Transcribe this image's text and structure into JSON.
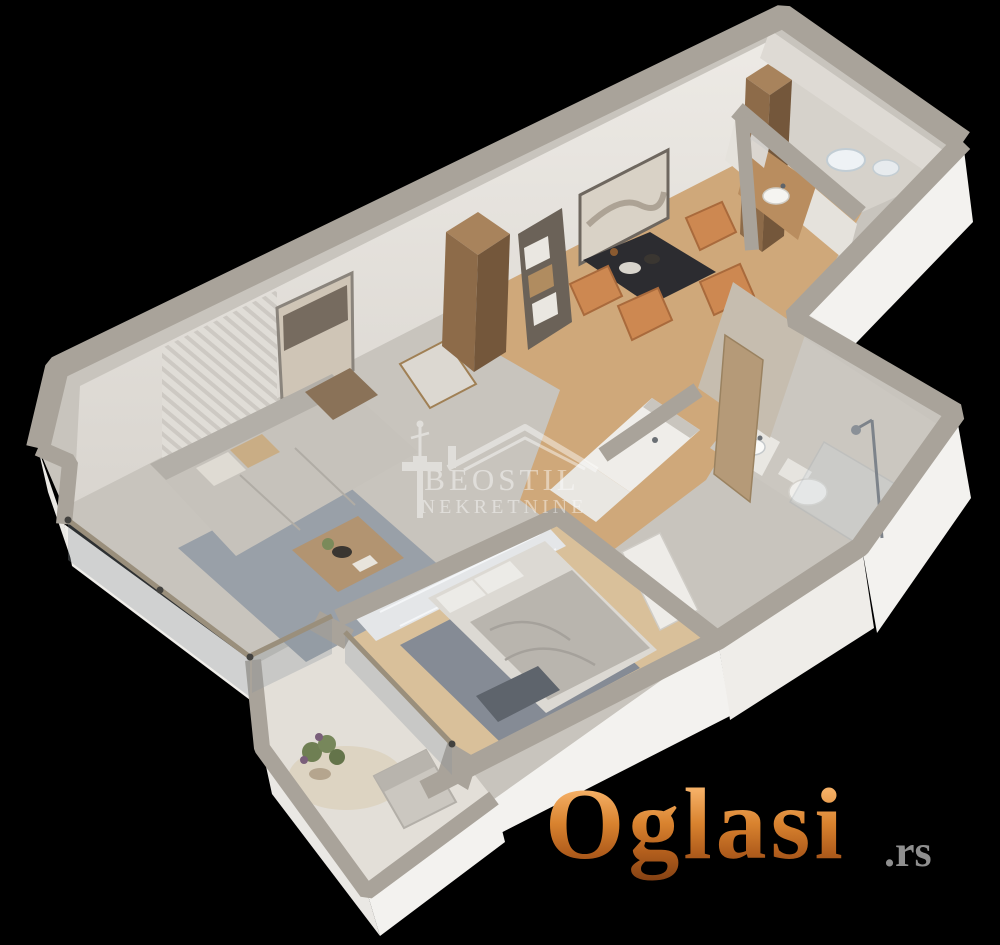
{
  "scene": {
    "type": "isometric-3d-floor-plan-render",
    "background_color": "#000000",
    "rooms": [
      "living-room",
      "dining-area",
      "kitchen-corridor",
      "hallway",
      "bathroom",
      "laundry-toilet",
      "bedroom",
      "terrace"
    ]
  },
  "watermark": {
    "title": "BEOSTIL",
    "subtitle": "NEKRETNINE",
    "symbols": [
      "house-roof-icon",
      "victor-monument-icon"
    ],
    "color": "#ffffff",
    "opacity": 0.45
  },
  "logo": {
    "name": "Oglasi",
    "tld": ".rs",
    "gradient": [
      "#f5b066",
      "#d9832f",
      "#b35f1d",
      "#7e3d12"
    ],
    "tld_color": "#8f8f8f"
  },
  "palette": {
    "wall_top": "#a9a39a",
    "wall_face_bright": "#f3f2ef",
    "wall_face_shaded": "#e2dfda",
    "base_floor": "#c8c4bd",
    "dining_wood_floor": "#cfa87a",
    "bedroom_wood_floor": "#d9c09a",
    "living_rug": "#99a0a8",
    "bedroom_rug": "#858b95",
    "terrace_floor": "#e3dfd8",
    "sofa": "#c6c2bb",
    "dining_chair": "#cd8851",
    "dining_table": "#2c2c30",
    "cabinet_wood": "#8d6b49"
  }
}
